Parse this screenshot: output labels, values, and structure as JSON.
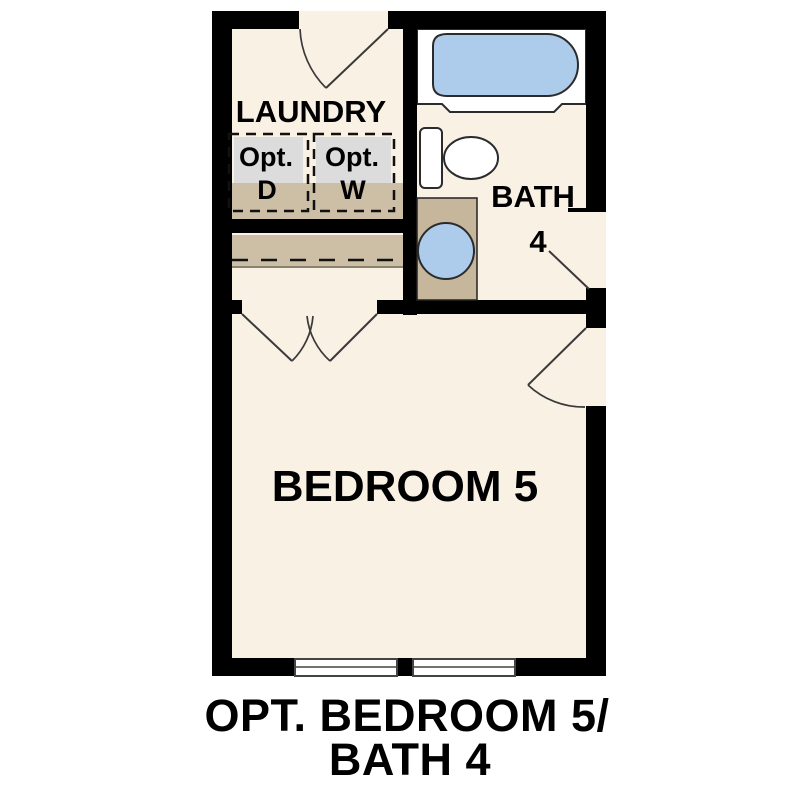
{
  "plan": {
    "caption_line1": "OPT. BEDROOM 5/",
    "caption_line2": "BATH 4",
    "rooms": {
      "laundry": {
        "label": "LAUNDRY"
      },
      "bath": {
        "label": "BATH",
        "number": "4"
      },
      "bedroom": {
        "label": "BEDROOM 5"
      }
    },
    "appliances": {
      "dryer": {
        "prefix": "Opt.",
        "letter": "D"
      },
      "washer": {
        "prefix": "Opt.",
        "letter": "W"
      }
    }
  },
  "colors": {
    "wall": "#000000",
    "floor": "#f8f1e4",
    "fixture_blue": "#adcbea",
    "fixture_white": "#ffffff",
    "cabinet_tan": "#c6b79c",
    "counter_tan": "#ccbfa6",
    "appliance_gray": "#dcdcdc"
  }
}
